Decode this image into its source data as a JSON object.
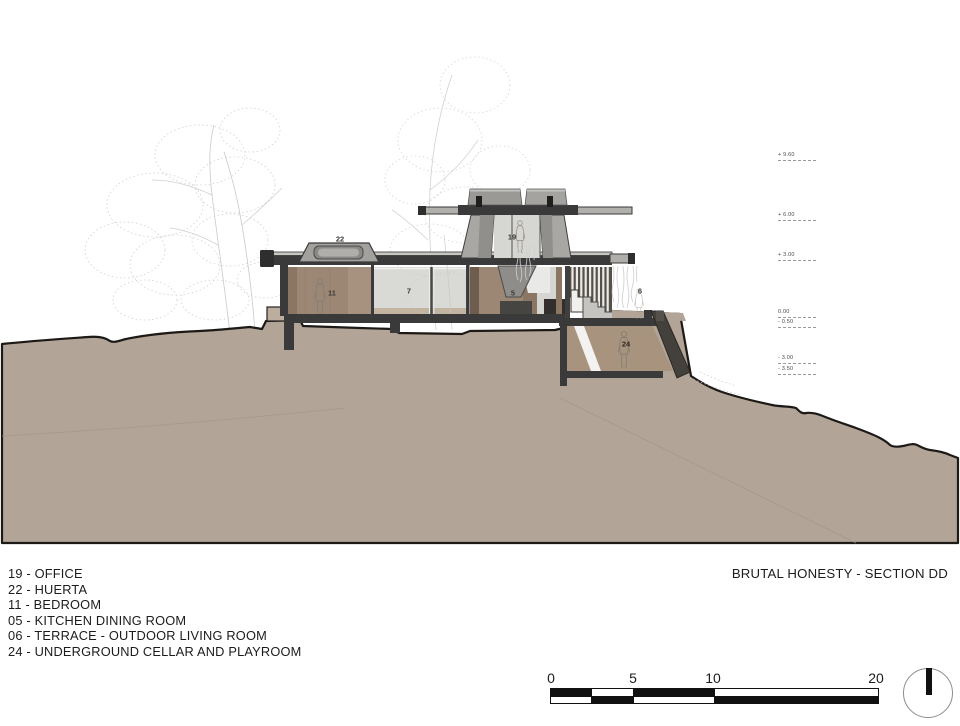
{
  "title": "BRUTAL HONESTY - SECTION DD",
  "legend": {
    "items": [
      "19 - OFFICE",
      "22 - HUERTA",
      "11 - BEDROOM",
      "05 - KITCHEN DINING ROOM",
      "06 - TERRACE - OUTDOOR LIVING ROOM",
      "24 - UNDERGROUND CELLAR AND PLAYROOM"
    ]
  },
  "room_labels": {
    "huerta": "22",
    "bedroom": "11",
    "patio": "7",
    "office": "19",
    "kitchen": "5",
    "terrace": "6",
    "cellar": "24"
  },
  "elevations": [
    "+ 9.60",
    "+ 6.00",
    "+ 3.00",
    "0.00",
    "- 0.50",
    "- 3.00",
    "- 3.50"
  ],
  "scale_bar": {
    "labels": [
      "0",
      "5",
      "10",
      "20"
    ]
  },
  "colors": {
    "terrain": "#b2a598",
    "terrain_edge": "#1c1916",
    "terrain_strata": "#a29584",
    "slab": "#3a3a3a",
    "wall_brown": "#9c8774",
    "wall_brown_dark": "#86715f",
    "wall_brown_light": "#a6927f",
    "glass": "#d9d9d6",
    "concrete": "#a9a7a4",
    "concrete_dark": "#918f8c",
    "underground_interior": "#a8937f",
    "tread": "#c6c4c1",
    "sketch": "#c9c9c9",
    "figure": "#877f72",
    "text": "#1c1c1c"
  }
}
